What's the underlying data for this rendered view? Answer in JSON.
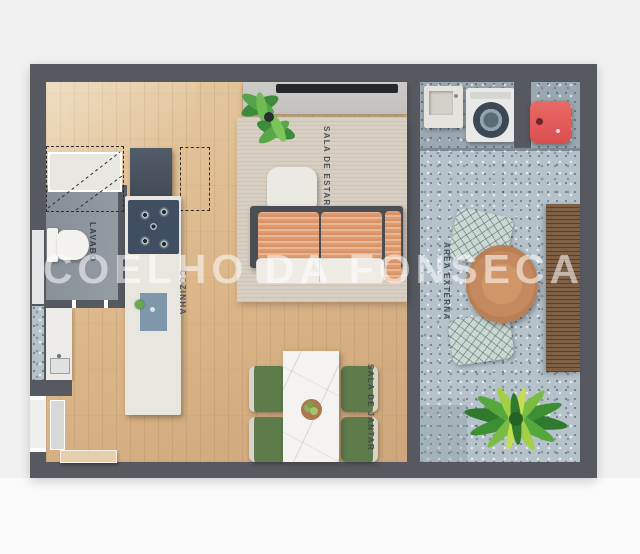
{
  "plan": {
    "type": "apartment-floor-plan",
    "watermark": {
      "text": "COELHO DA FONSECA",
      "color": "#ffffff"
    },
    "rooms": {
      "lavabo": {
        "label": "LAVABO"
      },
      "cozinha": {
        "label": "COZINHA"
      },
      "sala_de_estar": {
        "label": "SALA DE ESTAR"
      },
      "sala_de_jantar": {
        "label": "SALA DE JANTAR"
      },
      "area_externa": {
        "label": "ÁREA EXTERNA"
      }
    },
    "furniture_icons": [
      "toilet",
      "washbasin-counter",
      "refrigerator",
      "kitchen-island",
      "cooktop",
      "kitchen-sink",
      "tv-console",
      "tv",
      "monstera-plant",
      "area-rug",
      "pouf",
      "sofa",
      "dining-table",
      "dining-chair",
      "fruit-bowl",
      "laundry-sink",
      "washing-machine",
      "gas-heater",
      "round-patio-table",
      "wire-chair",
      "wood-deck-bench",
      "outdoor-plant",
      "entry-door"
    ],
    "colors": {
      "wall": "#56595f",
      "wood_floor": "#dab587",
      "terrazzo_floor": "#b6c2ca",
      "rug": "#d7cfc2",
      "sofa_cushion": "#e09a6d",
      "dining_chair_green": "#5d7b4b",
      "marble_table": "#f4f3f0",
      "round_table_wood": "#c5895f",
      "gas_heater_red": "#e05858",
      "plant_green": "#4c9a3c"
    }
  }
}
